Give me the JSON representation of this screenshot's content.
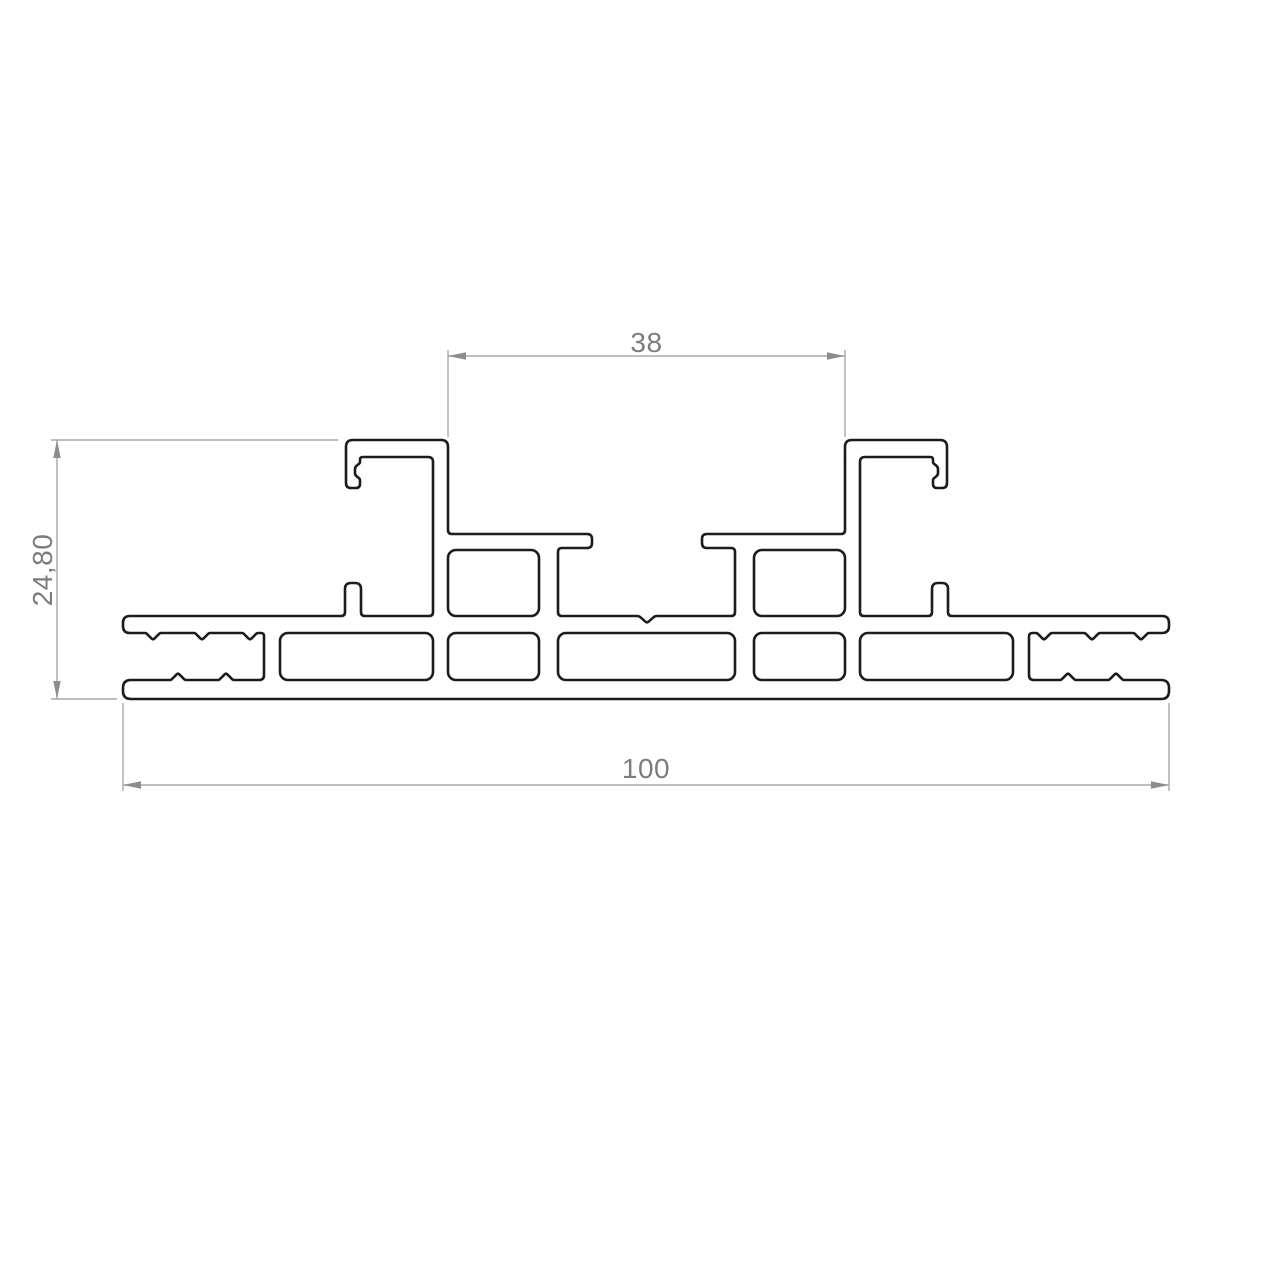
{
  "drawing": {
    "type": "technical-drawing",
    "description": "Aluminium extrusion profile cross-section with dimension annotations",
    "dimensions": [
      {
        "id": "top-slot-width",
        "label": "38",
        "orientation": "horizontal",
        "position": "top"
      },
      {
        "id": "overall-height",
        "label": "24,80",
        "orientation": "vertical",
        "position": "left"
      },
      {
        "id": "overall-width",
        "label": "100",
        "orientation": "horizontal",
        "position": "bottom"
      }
    ],
    "colors": {
      "background": "#ffffff",
      "profile_line": "#1c1c1c",
      "dimension_line": "#a8a8a8",
      "arrow": "#8c8c8c",
      "dimension_text": "#7d7d7d"
    }
  }
}
